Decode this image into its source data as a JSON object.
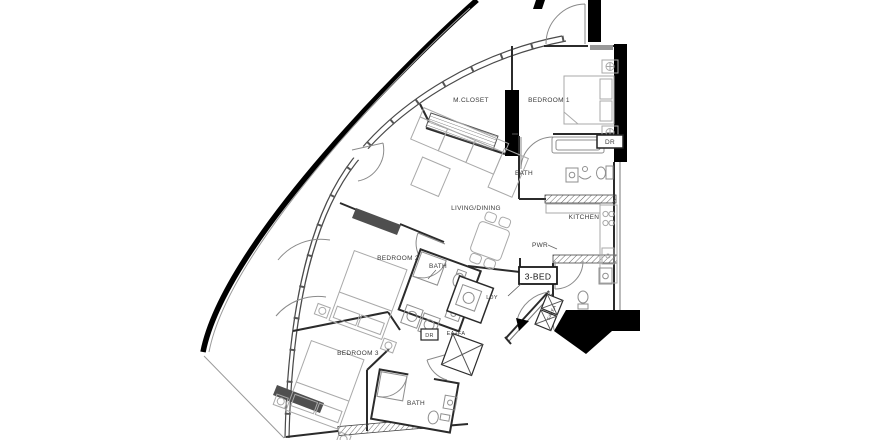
{
  "plan": {
    "unit_tag": {
      "label": "3-BED"
    },
    "rooms": {
      "m_closet": "M.CLOSET",
      "bedroom1": "BEDROOM 1",
      "master_bath": "BATH",
      "kitchen": "KITCHEN",
      "powder_room": "PWR",
      "living_dining": "LIVING/DINING",
      "bedroom2": "BEDROOM 2",
      "bath2": "BATH",
      "laundry": "LDY",
      "bedroom3": "BEDROOM 3",
      "bath3": "BATH"
    },
    "closets": {
      "dryer_master": "DR",
      "dryer_bath2": "DR"
    },
    "shafts": {
      "ea_fa": "EA+FA",
      "fa_ea": "FA+EA"
    },
    "colors": {
      "structure": "#000000",
      "walls": "#2b2b2b",
      "furniture": "#a9a9a9",
      "wardrobe_fill": "#4f4f4f",
      "background": "#ffffff",
      "text": "#3a3a3a"
    }
  }
}
